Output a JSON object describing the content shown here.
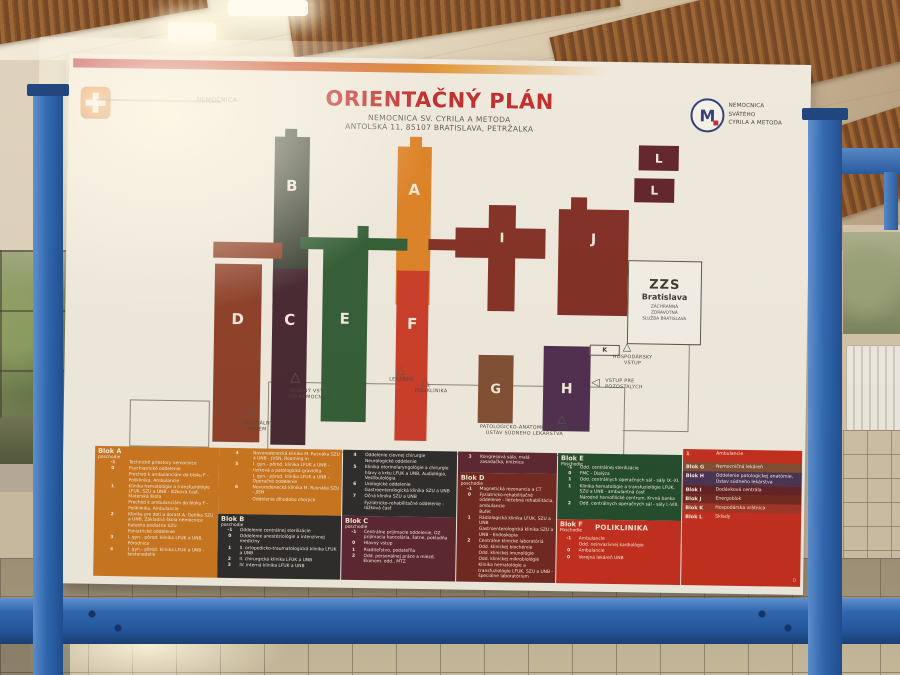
{
  "board": {
    "title": "ORIENTAČNÝ PLÁN",
    "subtitle1": "NEMOCNICA SV. CYRILA A METODA",
    "subtitle2": "ANTOLSKÁ 11, 85107 BRATISLAVA, PETRŽALKA",
    "logo_left_text": "NEMOCNICA",
    "logo_right_glyph": "M",
    "logo_right_line1": "NEMOCNICA",
    "logo_right_line2": "SVÄTÉHO",
    "logo_right_line3": "CYRILA A METODA"
  },
  "map": {
    "letters": {
      "a": "A",
      "b": "B",
      "c": "C",
      "d": "D",
      "e": "E",
      "f": "F",
      "g": "G",
      "h": "H",
      "i": "I",
      "j": "J",
      "k": "K",
      "l1": "L",
      "l2": "L"
    },
    "zzs": {
      "big": "ZZS",
      "name": "Bratislava",
      "s1": "ZÁCHRANNÁ",
      "s2": "ZDRAVOTNÁ",
      "s3": "SLUŽBA BRATISLAVA"
    },
    "icons": {
      "triangle": "△",
      "triangle_left": "◁"
    },
    "labels": {
      "hlavny1": "HLAVNÝ VSTUP",
      "hlavny2": "DO NEMOCNICE",
      "centralny1": "CENTRÁLNY",
      "centralny2": "PRÍJEM",
      "lekaren": "LEKÁREŇ",
      "poliklinika": "POLIKLINIKA",
      "hospodarsky1": "HOSPODÁRSKY",
      "hospodarsky2": "VSTUP",
      "pozostali1": "VSTUP PRE",
      "pozostali2": "POZOSTALÝCH",
      "patologia1": "PATOLOGICKO-ANATOMICKÉ ODD.",
      "patologia2": "ÚSTAV SÚDNEHO LEKÁRSTVA"
    }
  },
  "legend": {
    "blokA": {
      "title": "Blok A",
      "sub": "poschodie",
      "rows": [
        {
          "f": "-1",
          "t": "Technické priestory nemocnice"
        },
        {
          "f": "0",
          "t": "Psychiatrické oddelenie"
        },
        {
          "f": "",
          "t": "Prechod k ambulanciám do bloku F - Poliklinika, Ambulancie"
        },
        {
          "f": "1",
          "t": "Klinika hematológie a transfuziológie LFUK, SZU a UNB - lôžková časť, Materská škola"
        },
        {
          "f": "",
          "t": "Prechod k ambulanciám do bloku F - Poliklinika, Ambulancie"
        },
        {
          "f": "2",
          "t": "Klinika pre deti a dorast A. Getlíka SZU a UNB, Základná škola nemocnice"
        },
        {
          "f": "",
          "t": "Katedra pediatrie SZU"
        },
        {
          "f": "",
          "t": "Foniatrické oddelenie"
        },
        {
          "f": "3",
          "t": "I. gyn.- pôrod. klinika LFUK a UNB, Pôrodnica"
        },
        {
          "f": "4",
          "t": "I. gyn.- pôrod. klinika LFUK a UNB - šestonedelie"
        }
      ]
    },
    "blokA2": {
      "rows": [
        {
          "f": "4",
          "t": "Novorodenecká klinika M. Rusnáka SZU a UNB - JVSN, Rooming in"
        },
        {
          "f": "5",
          "t": "I. gyn.- pôrod. klinika LFUK a UNB - riziková a patologická gravidita"
        },
        {
          "f": "",
          "t": "I. gyn.- pôrod. klinika LFUK a UNB - Operačné oddelenie"
        },
        {
          "f": "6",
          "t": "Novorodenecká klinika M. Rusnáka SZU - JISN"
        },
        {
          "f": "",
          "t": "Oddelenie dlhodobo chorých"
        }
      ]
    },
    "blokB": {
      "title": "Blok B",
      "sub": "poschodie",
      "rows": [
        {
          "f": "-1",
          "t": "Oddelenie centrálnej sterilizácie"
        },
        {
          "f": "0",
          "t": "Oddelenie anestéziológie a intenzívnej medicíny"
        },
        {
          "f": "1",
          "t": "II. ortopedicko-traumatologická klinika LFUK a UNB"
        },
        {
          "f": "2",
          "t": "II. chirurgická klinika LFUK a UNB"
        },
        {
          "f": "3",
          "t": "IV. interná klinika LFUK a UNB"
        }
      ]
    },
    "blokB2": {
      "rows": [
        {
          "f": "4",
          "t": "Oddelenie cievnej chirurgie"
        },
        {
          "f": "",
          "t": "Neurologické oddelenie"
        },
        {
          "f": "5",
          "t": "Klinika otorinolaryngológie a chirurgie hlavy a krku LFUK a UNB, Audiológia, Vestibulológia"
        },
        {
          "f": "6",
          "t": "Urologické oddelenie"
        },
        {
          "f": "",
          "t": "Gastroenterologická klinika SZU a UNB"
        },
        {
          "f": "7",
          "t": "Očná klinika SZU a UNB"
        },
        {
          "f": "",
          "t": "Fyziatricko-rehabilitačné oddelenie - lôžková časť"
        }
      ]
    },
    "blokC": {
      "title": "Blok C",
      "sub": "poschodie",
      "rows": [
        {
          "f": "-1",
          "t": "Centrálne prijímacie oddelenie, OZ prijímacia kancelária, šatne, pokladňa"
        },
        {
          "f": "0",
          "t": "Hlavný vstup"
        },
        {
          "f": "1",
          "t": "Riaditeľstvo, podateľňa"
        },
        {
          "f": "2",
          "t": "Odd. personálnej práce a miezd, Ekonom. odd., MTZ"
        }
      ]
    },
    "blokC2": {
      "rows": [
        {
          "f": "3",
          "t": "Kongresová sála, malá zasadačka, knižnica"
        }
      ]
    },
    "blokD": {
      "title": "Blok D",
      "sub": "poschodie",
      "rows": [
        {
          "f": "-1",
          "t": "Magnetická rezonancia a CT"
        },
        {
          "f": "0",
          "t": "Fyziatricko-rehabilitačné oddelenie - liečebná rehabilitácia, ambulancie"
        },
        {
          "f": "",
          "t": "Bufet"
        },
        {
          "f": "1",
          "t": "Rádiologická klinika LFUK, SZU a UNB"
        },
        {
          "f": "",
          "t": "Gastroenterologická klinika SZU a UNB - Endoskopia"
        },
        {
          "f": "2",
          "t": "Centrálne klinické laboratóriá"
        },
        {
          "f": "",
          "t": "Odd. klinickej biochémie"
        },
        {
          "f": "",
          "t": "Odd. klinickej imunológie"
        },
        {
          "f": "",
          "t": "Odd. klinickej mikrobiológie"
        },
        {
          "f": "",
          "t": "Klinika hematológie a transfuziológie LFUK, SZU a UNB - špeciálne laboratórium"
        }
      ]
    },
    "blokE": {
      "title": "Blok E",
      "sub": "Poschodie",
      "rows": [
        {
          "f": "-1",
          "t": "Odd. centrálnej sterilizácie"
        },
        {
          "f": "0",
          "t": "FMC - Dialýza"
        },
        {
          "f": "1",
          "t": "Odd. centrálnych operačných sál - sály IX.-XI."
        },
        {
          "f": "1",
          "t": "Klinika hematológie a transfuziológie LFUK, SZU a UNB - ambulantná časť"
        },
        {
          "f": "",
          "t": "Národné hemofilické centrum, Krvná banka"
        },
        {
          "f": "2",
          "t": "Odd. centrálnych operačných sál - sály I.-VIII."
        }
      ]
    },
    "blokF": {
      "title": "Blok F",
      "sub": "Poschodie",
      "name": "POLIKLINIKA",
      "rows": [
        {
          "f": "-1",
          "t": "Ambulancie"
        },
        {
          "f": "",
          "t": "Odd. neinvazívnej kardiológie"
        },
        {
          "f": "0",
          "t": "Ambulancie"
        },
        {
          "f": "0",
          "t": "Verejná lekáreň UNB"
        }
      ]
    },
    "others": {
      "amb": {
        "f": "1",
        "t": "Ambulancie"
      },
      "mark": "D",
      "rows": [
        {
          "label": "Blok G",
          "t": "Nemocničná lekáreň",
          "bg": "#7d4c32"
        },
        {
          "label": "Blok H",
          "t": "Oddelenie patologickej anatómie, Ústav súdneho lekárstva",
          "bg": "#443052"
        },
        {
          "label": "Blok I",
          "t": "Dodávková centrála",
          "bg": "#5e1f24"
        },
        {
          "label": "Blok J",
          "t": "Energoblok",
          "bg": "#6e2520"
        },
        {
          "label": "Blok K",
          "t": "Hospodárska vrátnica",
          "bg": "#9e3226"
        },
        {
          "label": "Blok L",
          "t": "Sklady",
          "bg": "#c22b1d"
        }
      ]
    }
  },
  "colors": {
    "accent_red": "#C1292B",
    "orange": "#C8741E",
    "frame_blue": "#2B66B4"
  }
}
